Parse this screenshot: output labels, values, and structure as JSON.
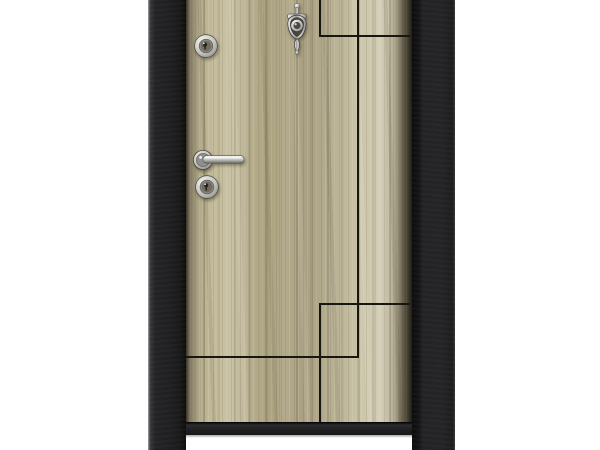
{
  "scene": {
    "subject": "Steel security door product photo: black steel frame, wood-grain laminate leaf with rectangular groove pattern, chrome hardware, white background"
  },
  "colors": {
    "bg": "#ffffff",
    "frame-base": "#232325",
    "frame-edge-light": "#9a9a9a",
    "door-gap": "#0d0d0d",
    "wood-base": "#b6ae8f",
    "wood-light": "#cdc7ad",
    "wood-dark": "#8f876c",
    "groove": "#17160f",
    "rail": "#1a1a1c",
    "chrome-light": "#f2f2f2",
    "chrome-mid": "#b5b5b5",
    "chrome-dark": "#6e6e6e"
  },
  "hardware": {
    "knocker": "door-knocker-with-peephole",
    "lock_top": "cylinder-lock-top",
    "handle": "lever-handle",
    "lock_bottom": "cylinder-lock-bottom"
  }
}
